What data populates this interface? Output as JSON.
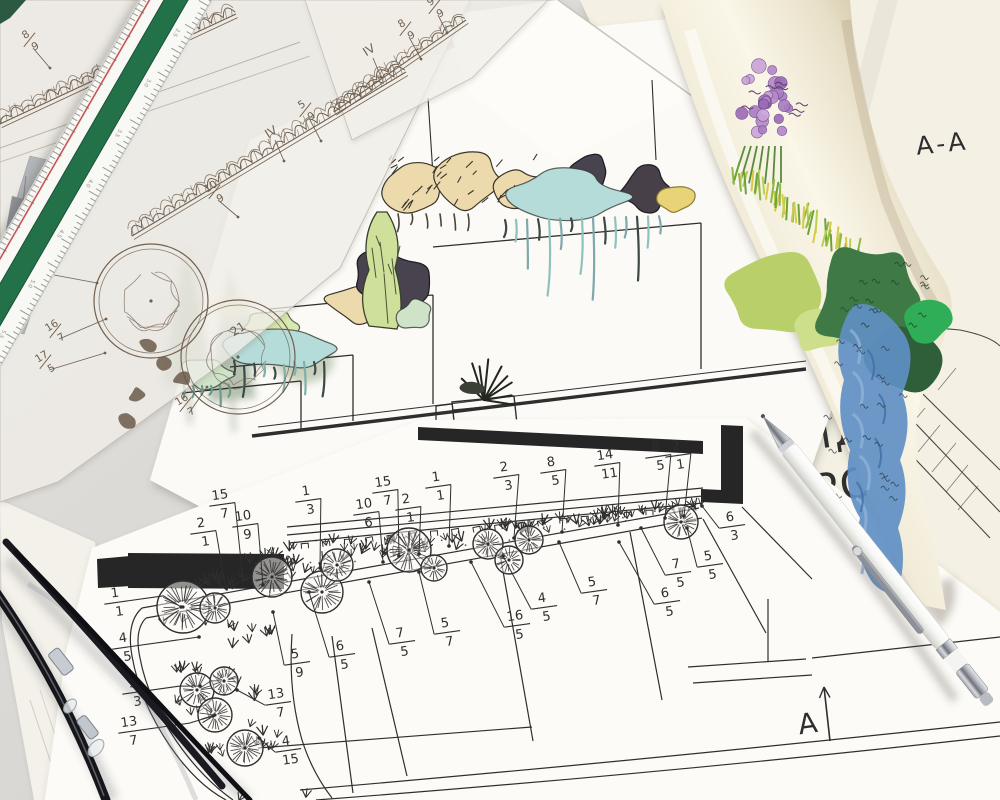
{
  "scene": {
    "kind": "photo-of-landscape-architecture-drawings",
    "objects": [
      "tracing-paper-sketches",
      "scale-ruler",
      "colored-elevation-drawing",
      "rolled-color-rendering",
      "planting-plan",
      "white-pen",
      "eyeglasses"
    ]
  },
  "texts": {
    "section_title": "А-А",
    "idea": "ИД",
    "project": "РО",
    "arrow": "А"
  },
  "colors": {
    "ink": "#2f2f2f",
    "sepia": "#70604f",
    "teal": "#b5dcd9",
    "tan": "#ecd9ac",
    "plum": "#4a4250",
    "cypress": "#cfe09a",
    "mint": "#cfe3c8",
    "grass": "#8fb944",
    "purple": "#b487c9",
    "blue": "#5f8fc4",
    "dark_green": "#3f7a46",
    "yellow_green": "#b9cf6a",
    "yellow": "#e8d377",
    "ruler_green": "#20714a",
    "ruler_red": "#c24040"
  },
  "ruler": {
    "numbers": [
      "2.0",
      "2.5",
      "3.0",
      "3.5",
      "4.0",
      "4.5",
      "5.0",
      "5.5",
      "6.0"
    ]
  },
  "plan_labels": [
    {
      "n": "2",
      "d": "1",
      "x": 202,
      "y": 531,
      "tx": 224,
      "ty": 578
    },
    {
      "n": "15",
      "d": "7",
      "x": 221,
      "y": 503,
      "tx": 243,
      "ty": 580
    },
    {
      "n": "10",
      "d": "9",
      "x": 244,
      "y": 524,
      "tx": 263,
      "ty": 585
    },
    {
      "n": "1",
      "d": "3",
      "x": 307,
      "y": 499,
      "tx": 320,
      "ty": 568
    },
    {
      "n": "10",
      "d": "6",
      "x": 365,
      "y": 512,
      "tx": 383,
      "ty": 562
    },
    {
      "n": "15",
      "d": "7",
      "x": 384,
      "y": 490,
      "tx": 399,
      "ty": 556
    },
    {
      "n": "2",
      "d": "1",
      "x": 407,
      "y": 507,
      "tx": 419,
      "ty": 554
    },
    {
      "n": "1",
      "d": "1",
      "x": 437,
      "y": 485,
      "tx": 449,
      "ty": 546
    },
    {
      "n": "2",
      "d": "3",
      "x": 505,
      "y": 475,
      "tx": 514,
      "ty": 538
    },
    {
      "n": "8",
      "d": "5",
      "x": 552,
      "y": 470,
      "tx": 562,
      "ty": 532
    },
    {
      "n": "14",
      "d": "11",
      "x": 606,
      "y": 463,
      "tx": 618,
      "ty": 525
    },
    {
      "n": "8",
      "d": "5",
      "x": 657,
      "y": 455,
      "tx": 665,
      "ty": 518
    },
    {
      "n": "2",
      "d": "1",
      "x": 677,
      "y": 454,
      "tx": 684,
      "ty": 516
    },
    {
      "n": "6",
      "d": "3",
      "x": 731,
      "y": 525,
      "tx": 702,
      "ty": 506
    },
    {
      "n": "5",
      "d": "5",
      "x": 709,
      "y": 564,
      "tx": 687,
      "ty": 528
    },
    {
      "n": "7",
      "d": "5",
      "x": 677,
      "y": 572,
      "tx": 641,
      "ty": 528
    },
    {
      "n": "6",
      "d": "5",
      "x": 666,
      "y": 601,
      "tx": 619,
      "ty": 542
    },
    {
      "n": "5",
      "d": "7",
      "x": 593,
      "y": 590,
      "tx": 559,
      "ty": 542
    },
    {
      "n": "4",
      "d": "5",
      "x": 543,
      "y": 606,
      "tx": 503,
      "ty": 556
    },
    {
      "n": "16",
      "d": "5",
      "x": 516,
      "y": 624,
      "tx": 471,
      "ty": 562
    },
    {
      "n": "5",
      "d": "7",
      "x": 446,
      "y": 631,
      "tx": 419,
      "ty": 572
    },
    {
      "n": "7",
      "d": "5",
      "x": 401,
      "y": 641,
      "tx": 369,
      "ty": 582
    },
    {
      "n": "6",
      "d": "5",
      "x": 341,
      "y": 654,
      "tx": 309,
      "ty": 592
    },
    {
      "n": "5",
      "d": "9",
      "x": 296,
      "y": 662,
      "tx": 273,
      "ty": 612
    },
    {
      "n": "13",
      "d": "7",
      "x": 277,
      "y": 702,
      "tx": 237,
      "ty": 690
    },
    {
      "n": "4",
      "d": "15",
      "x": 287,
      "y": 749,
      "tx": 259,
      "ty": 738
    },
    {
      "n": "1",
      "d": "1",
      "x": 116,
      "y": 601,
      "tx": 181,
      "ty": 607,
      "ext": 48
    },
    {
      "n": "4",
      "d": "5",
      "x": 124,
      "y": 646,
      "tx": 199,
      "ty": 637,
      "ext": 54
    },
    {
      "n": "3",
      "d": "3",
      "x": 134,
      "y": 691,
      "tx": 200,
      "ty": 686,
      "ext": 46
    },
    {
      "n": "13",
      "d": "7",
      "x": 130,
      "y": 730,
      "tx": 213,
      "ty": 716,
      "ext": 60
    }
  ],
  "sketch_labels": [
    {
      "n": "8",
      "d": "9",
      "x": 29,
      "y": 40,
      "tx": 50,
      "ty": 68
    },
    {
      "n": "10",
      "d": "9",
      "x": 214,
      "y": 192,
      "tx": 238,
      "ty": 217
    },
    {
      "t": "IV",
      "x": 271,
      "y": 132,
      "tx": 284,
      "ty": 161
    },
    {
      "n": "5",
      "d": "9",
      "x": 305,
      "y": 110,
      "tx": 321,
      "ty": 141
    },
    {
      "t": "IV",
      "x": 369,
      "y": 50,
      "tx": 381,
      "ty": 77
    },
    {
      "n": "8",
      "d": "9",
      "x": 405,
      "y": 29,
      "tx": 421,
      "ty": 59
    },
    {
      "n": "9",
      "d": "9",
      "x": 434,
      "y": 7,
      "tx": 447,
      "ty": 33
    },
    {
      "t": "23",
      "x": 34,
      "y": 264,
      "tx": 97,
      "ty": 283
    },
    {
      "t": "21",
      "x": 238,
      "y": 329
    },
    {
      "n": "16",
      "d": "7",
      "x": 55,
      "y": 331,
      "tx": 106,
      "ty": 319
    },
    {
      "n": "17",
      "d": "5",
      "x": 45,
      "y": 362,
      "tx": 105,
      "ty": 353
    },
    {
      "n": "16",
      "d": "7",
      "x": 185,
      "y": 405,
      "tx": 207,
      "ty": 387
    }
  ],
  "plan_trees": [
    [
      183,
      607,
      26
    ],
    [
      215,
      608,
      15
    ],
    [
      272,
      577,
      20
    ],
    [
      322,
      592,
      21
    ],
    [
      337,
      565,
      16
    ],
    [
      409,
      550,
      22
    ],
    [
      434,
      568,
      13
    ],
    [
      488,
      544,
      15
    ],
    [
      509,
      560,
      14
    ],
    [
      529,
      540,
      14
    ],
    [
      681,
      522,
      17
    ]
  ],
  "corner_trees": [
    [
      197,
      690,
      17
    ],
    [
      224,
      681,
      14
    ],
    [
      215,
      715,
      17
    ],
    [
      245,
      748,
      18
    ]
  ],
  "sketch_circles": [
    [
      151,
      301,
      57
    ],
    [
      238,
      357,
      57
    ]
  ]
}
